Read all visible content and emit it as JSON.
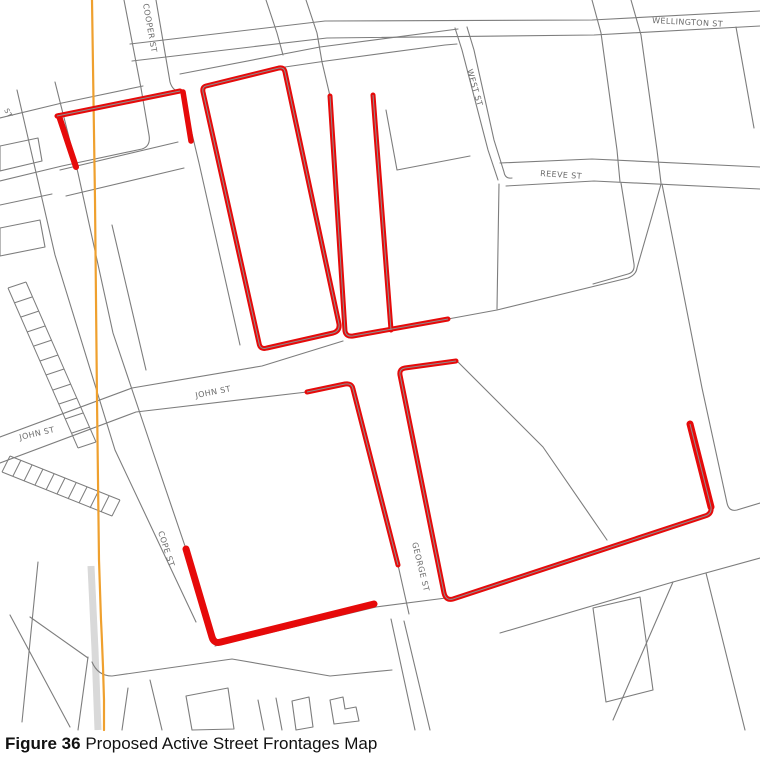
{
  "figure": {
    "caption_label": "Figure 36",
    "caption_title": " Proposed Active Street Frontages Map"
  },
  "map": {
    "colors": {
      "background": "#ffffff",
      "parcel_gray": "#7d7d7d",
      "centerline_gray": "#8f8f8f",
      "frontage_red": "#e60a0a",
      "route_orange": "#efa02e",
      "road_band": "#d9d9d9",
      "label_gray": "#6b6b6b"
    },
    "street_labels": [
      {
        "name": "cooper-st",
        "text": "COOPER ST",
        "x": 143,
        "y": 4,
        "rotate": 80,
        "size": 8
      },
      {
        "name": "wellington-st",
        "text": "WELLINGTON ST",
        "x": 652,
        "y": 23,
        "rotate": 3,
        "size": 8
      },
      {
        "name": "west-st",
        "text": "WEST ST",
        "x": 467,
        "y": 70,
        "rotate": 74,
        "size": 8
      },
      {
        "name": "reeve-st",
        "text": "REEVE ST",
        "x": 540,
        "y": 176,
        "rotate": 4,
        "size": 8
      },
      {
        "name": "john-st-east",
        "text": "JOHN ST",
        "x": 196,
        "y": 398,
        "rotate": -11,
        "size": 8
      },
      {
        "name": "john-st-west",
        "text": "JOHN ST",
        "x": 20,
        "y": 440,
        "rotate": -13,
        "size": 8
      },
      {
        "name": "cope-st",
        "text": "COPE ST",
        "x": 158,
        "y": 532,
        "rotate": 72,
        "size": 8
      },
      {
        "name": "george-st",
        "text": "GEORGE ST",
        "x": 412,
        "y": 543,
        "rotate": 76,
        "size": 8
      },
      {
        "name": "st-fragment",
        "text": "ST",
        "x": 4,
        "y": 110,
        "rotate": 62,
        "size": 7
      }
    ],
    "gray_paths": [
      "M 124,0 L 141,88 L 149,135 Q 151,146 142,149 L 62,166 L 0,181",
      "M 0,118 L 62,103 L 143,86",
      "M 156,0 L 170,82 Q 173,92 181,91",
      "M 57,116 L 180,91",
      "M 182,92 L 199,163 L 240,345",
      "M 130,44 L 325,21 L 592,20 L 760,11",
      "M 132,61 L 327,38 L 594,35 L 760,26",
      "M 266,0 L 277,33 L 283,55",
      "M 306,0 L 317,33 L 322,62",
      "M 322,62 L 330,96",
      "M 180,74 L 320,47 L 458,29",
      "M 285,67 L 326,61 L 445,45 L 457,44",
      "M 455,28 L 462,50 L 488,150 L 498,180",
      "M 467,27 L 474,50 L 494,140 L 504,172 Q 505,179 512,178",
      "M 500,163 L 592,159 L 760,167",
      "M 506,186 L 594,181 L 760,189",
      "M 592,0 L 601,33 L 617,150 L 620,182",
      "M 621,183 L 634,264 Q 635,272 628,274 L 593,284",
      "M 631,0 L 641,35 L 657,150 L 661,183",
      "M 662,184 L 702,388 L 727,503 Q 729,512 737,510 L 760,503",
      "M 736,27 L 754,128",
      "M 386,110 L 397,170 L 470,156",
      "M 448,319 L 497,310 L 628,278 Q 636,275 637,268 L 652,216 L 661,184",
      "M 499,184 L 497,309",
      "M 0,437 L 132,388 L 262,366 L 343,341",
      "M 0,463 L 136,412 L 307,392",
      "M 458,362 L 543,447 L 607,540",
      "M 398,565 L 409,614",
      "M 391,619 L 415,730",
      "M 404,621 L 430,730",
      "M 215,646 L 376,607 L 446,598",
      "M 92,662 Q 98,676 112,676 L 232,659 L 330,676 L 392,670",
      "M 500,633 L 673,582 L 760,558",
      "M 673,582 L 613,720",
      "M 593,608 L 640,597 L 653,690 L 606,702 Z",
      "M 706,573 L 745,730",
      "M 17,90 L 55,255 L 115,450 L 196,622",
      "M 55,82 L 78,173 L 113,333 L 153,452 L 186,549 L 213,640",
      "M 88,657 L 78,730",
      "M 10,615 L 70,727",
      "M 38,562 L 22,722",
      "M 30,617 L 88,658",
      "M 60,170 L 178,142",
      "M 66,196 L 184,168",
      "M 112,225 L 146,370",
      "M 0,146 L 38,138 L 42,161 L 0,171 Z",
      "M 0,228 L 40,220 L 45,247 L 0,256 Z",
      "M 0,205 L 52,194",
      "M 186,696 L 228,688 L 234,729 L 192,730 Z",
      "M 258,700 L 264,730",
      "M 276,698 L 282,730",
      "M 292,701 L 309,697 L 313,727 L 296,730 Z",
      "M 330,700 L 343,697 L 345,709 L 356,707 L 359,721 L 334,724 Z",
      "M 128,688 L 122,730",
      "M 150,680 L 162,730"
    ],
    "hatch_paths": [
      "M 8,288 L 78,448 M 26,282 L 96,442 M 8,288 L 26,282 M 14,303 L 32,297 M 21,317 L 39,311 M 27,332 L 45,326 M 34,346 L 52,340 M 40,361 L 58,355 M 46,375 L 64,369 M 53,390 L 71,384 M 59,404 L 77,398 M 65,419 L 83,413 M 72,433 L 90,427 M 78,448 L 96,442",
      "M 10,456 L 120,500 M 2,472 L 112,516 M 10,456 L 2,472 M 21,460 L 13,476 M 32,465 L 24,481 M 43,469 L 35,485 M 54,474 L 46,490 M 65,478 L 57,494 M 76,483 L 68,499 M 87,487 L 79,503 M 98,492 L 90,508 M 109,496 L 101,512 M 120,500 L 112,516"
    ],
    "road_band_path": "M 91,566 L 95,650 L 98,730",
    "orange_path": "M 92,0 L 95,200 L 97,400 L 99,560 L 101,620 Q 103,660 104,700 L 104,730",
    "red_paths": [
      {
        "name": "frontage-block-a-left",
        "d": "M 59,116 L 76,167",
        "w": 6,
        "centerline": false
      },
      {
        "name": "frontage-block-a-top",
        "d": "M 57,116 L 180,91",
        "w": 5,
        "centerline": true
      },
      {
        "name": "frontage-block-a-right",
        "d": "M 183,92 L 191,141",
        "w": 5.5,
        "centerline": false
      },
      {
        "name": "frontage-block-b-loop",
        "d": "M 206,86 L 279,68 Q 284,67 285,72 L 339,324 Q 340,331 333,333 L 267,348 Q 260,350 259,343 L 203,92 Q 202,87 206,86 Z",
        "w": 5,
        "centerline": true
      },
      {
        "name": "frontage-george-west-north",
        "d": "M 330,96 L 345,331 Q 346,337 353,336 L 448,319",
        "w": 5,
        "centerline": true
      },
      {
        "name": "frontage-george-east-north",
        "d": "M 373,95 L 391,330",
        "w": 5,
        "centerline": true
      },
      {
        "name": "frontage-george-west-south",
        "d": "M 307,392 L 345,384 Q 352,383 353,389 L 398,565",
        "w": 5,
        "centerline": true
      },
      {
        "name": "frontage-george-east-south-chain",
        "d": "M 456,361 L 405,368 Q 399,369 400,375 L 444,593 Q 446,601 453,599 L 705,516 Q 712,514 711,507 L 690,424",
        "w": 5,
        "centerline": true
      },
      {
        "name": "frontage-east-vertical",
        "d": "M 690,424 L 711,507",
        "w": 7,
        "centerline": false
      },
      {
        "name": "frontage-southwest-l",
        "d": "M 186,549 L 212,637 Q 214,644 221,642 L 374,604",
        "w": 7,
        "centerline": false
      }
    ]
  }
}
